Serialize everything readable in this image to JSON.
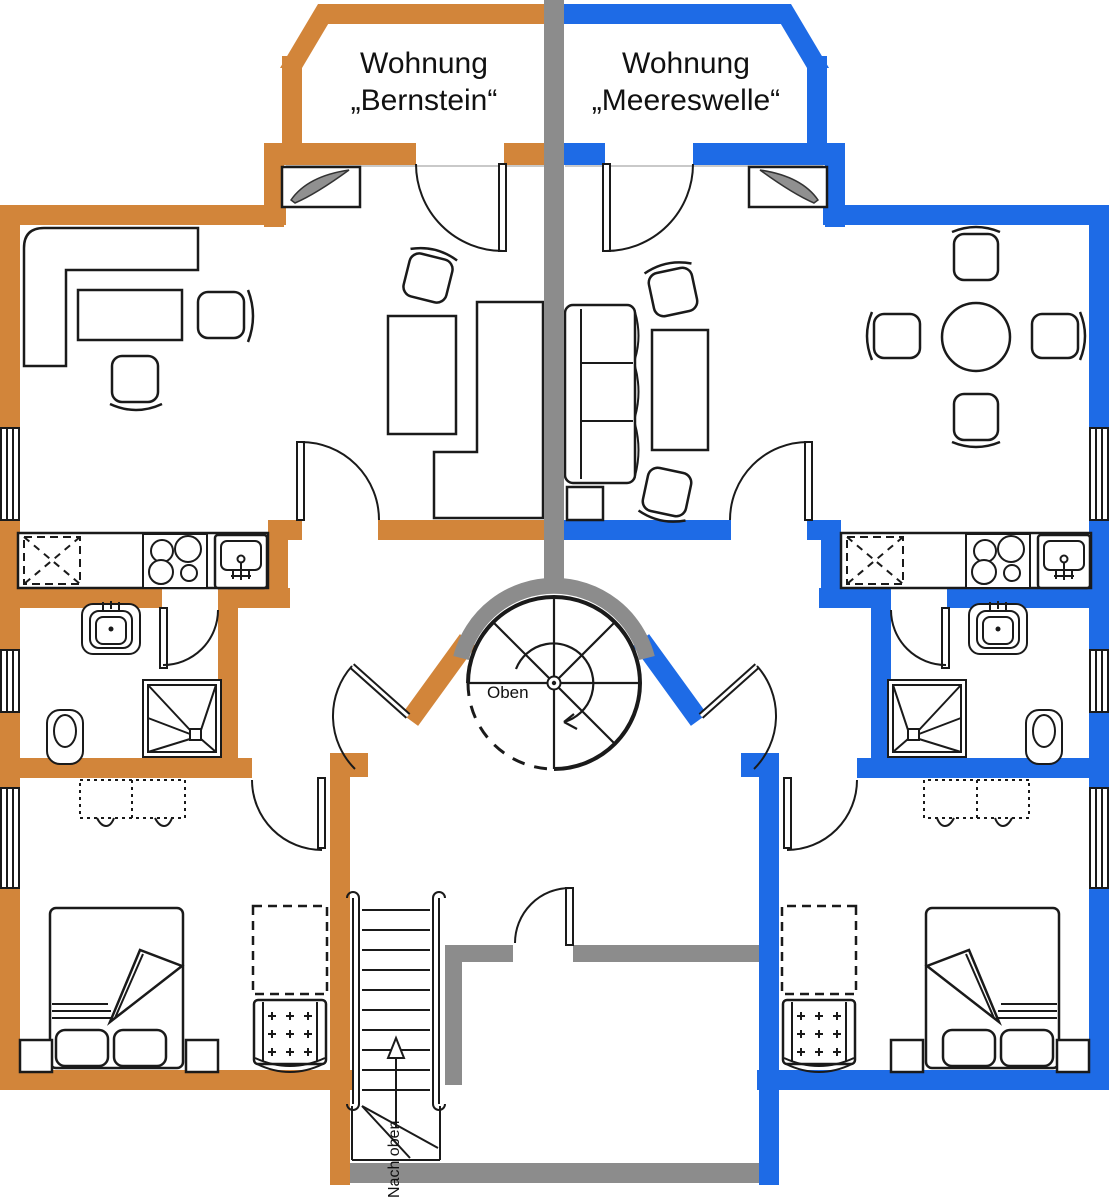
{
  "page": {
    "width": 1109,
    "height": 1200,
    "background": "#FFFFFF",
    "type": "architectural floor plan of two holiday apartments"
  },
  "labels": {
    "apartment_left_line1": "Wohnung",
    "apartment_left_line2": "„Bernstein“",
    "apartment_right_line1": "Wohnung",
    "apartment_right_line2": "„Meereswelle“",
    "spiral_stair": "Oben",
    "bottom_stairs": "Nach oben"
  },
  "colors": {
    "bernstein_walls": "#D2853A",
    "meereswelle_walls": "#1E6BE6",
    "shared_walls": "#8C8C8C",
    "drawing_lines": "#1A1A1A",
    "text": "#111111",
    "background": "#FFFFFF"
  },
  "elements": {
    "shared": [
      "center-party-wall",
      "spiral-staircase",
      "straight-staircase-up",
      "house-entrance-door"
    ],
    "per_apartment_fixtures": [
      "balcony-bay",
      "balcony-door",
      "living-room-door",
      "apartment-entry-door",
      "bathroom-door",
      "bedroom-door",
      "window",
      "kitchen-counter",
      "fridge",
      "cooktop",
      "kitchen-sink",
      "washbasin",
      "toilet",
      "shower"
    ],
    "furniture_bernstein": [
      "corner-sofa",
      "coffee-table",
      "armchair",
      "armchair",
      "tv-sideboard",
      "corner-sofa-center",
      "dining-side-table",
      "chair"
    ],
    "furniture_meereswelle": [
      "cushion-sofa",
      "side-table",
      "table",
      "chair",
      "chair",
      "tv-sideboard",
      "round-dining-table",
      "dining-chair",
      "dining-chair",
      "dining-chair",
      "dining-chair"
    ],
    "bedroom_each": [
      "double-bed",
      "pillow",
      "pillow",
      "nightstand",
      "nightstand",
      "wardrobe-dashed",
      "crib",
      "dresser-dashed"
    ]
  }
}
